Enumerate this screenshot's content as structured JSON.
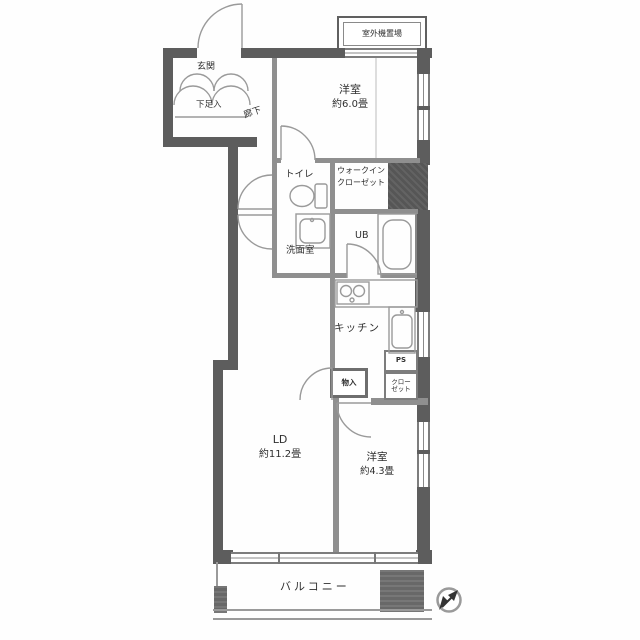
{
  "colors": {
    "wall": "#5d5d5d",
    "partition": "#8f8f8f",
    "line": "#9a9a9a",
    "text": "#2f2f2f",
    "shaft": "#565656",
    "balcony_block": "#686868"
  },
  "plan": {
    "entrance": {
      "genkan": "玄関",
      "shoebox": "下足入",
      "hallway": "廊下"
    },
    "outdoor_unit": "室外機置場",
    "bedroom1": {
      "name": "洋室",
      "size": "約6.0畳"
    },
    "toilet": "トイレ",
    "wic": {
      "line1": "ウォークイン",
      "line2": "クローゼット"
    },
    "washroom": "洗面室",
    "bath": "UB",
    "kitchen": "キッチン",
    "storage": "物入",
    "pipe_space": "PS",
    "closet": {
      "line1": "クロー",
      "line2": "ゼット"
    },
    "living": {
      "name": "LD",
      "size": "約11.2畳"
    },
    "bedroom2": {
      "name": "洋室",
      "size": "約4.3畳"
    },
    "balcony": "バルコニー"
  }
}
